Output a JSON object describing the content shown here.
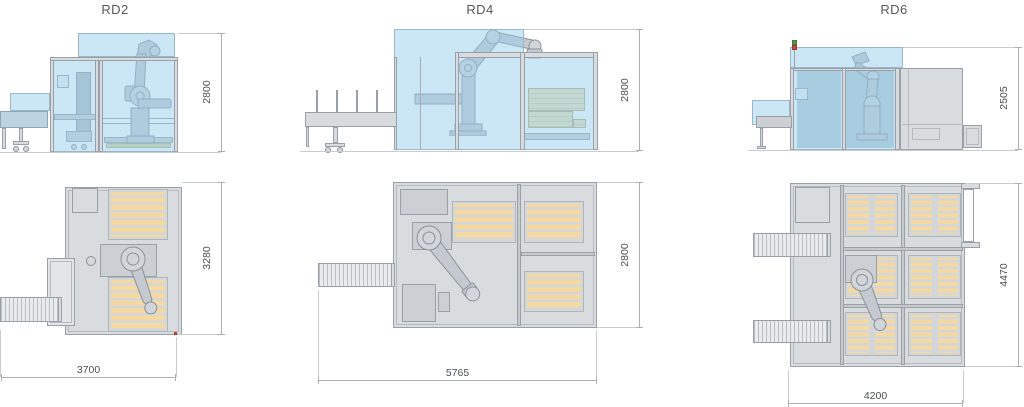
{
  "machines": [
    {
      "title": "RD2",
      "side": {
        "height": "2800"
      },
      "plan": {
        "depth": "3280",
        "width": "3700",
        "pallet_positions": 2
      }
    },
    {
      "title": "RD4",
      "side": {
        "height": "2800"
      },
      "plan": {
        "depth": "2800",
        "width": "5765",
        "pallet_positions": 3
      }
    },
    {
      "title": "RD6",
      "side": {
        "height": "2505"
      },
      "plan": {
        "depth": "4470",
        "width": "4200",
        "pallet_positions": 6
      }
    }
  ],
  "colors": {
    "glass_blue": "#cfe7f4",
    "pallet_wood": "#f6d9a1",
    "structure_gray": "#d9dcdf",
    "dimension_line": "#abafb3",
    "marker_red": "#c0392b",
    "beacon_green": "#4f9a4f",
    "beacon_red": "#c24a36"
  }
}
